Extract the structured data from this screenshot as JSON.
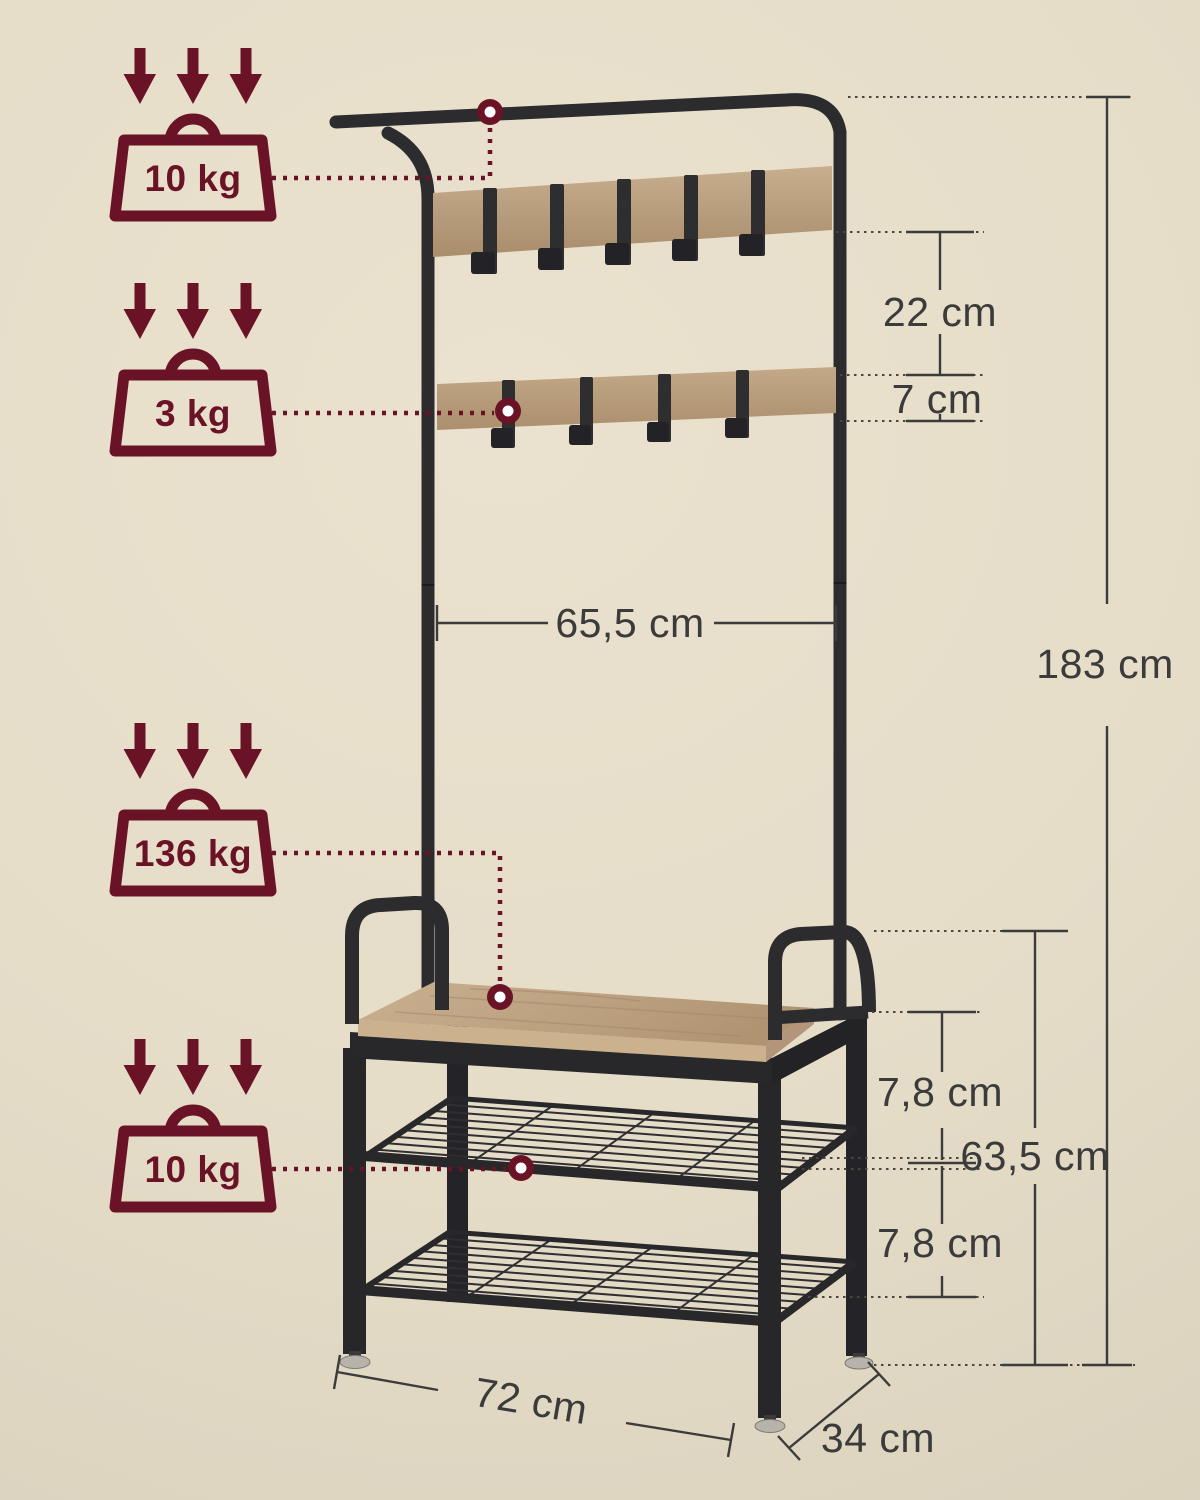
{
  "badges": [
    {
      "name": "rail-max-load",
      "label": "10 kg"
    },
    {
      "name": "hook-board-max-load",
      "label": "3 kg"
    },
    {
      "name": "bench-max-load",
      "label": "136 kg"
    },
    {
      "name": "shelf-max-load",
      "label": "10 kg"
    }
  ],
  "dimensions": {
    "board_gap": "22 cm",
    "board_height": "7 cm",
    "inner_width": "65,5 cm",
    "total_height": "183 cm",
    "seat_to_shelf": "7,8 cm",
    "bench_height": "63,5 cm",
    "shelf_gap": "7,8 cm",
    "bench_width": "72 cm",
    "bench_depth": "34 cm"
  },
  "colors": {
    "background": "#e5ddc8",
    "accent_maroon": "#6b1326",
    "metal_black": "#2c2c2f",
    "wood": "#bda183",
    "dimension_gray": "#3b3b3b"
  }
}
